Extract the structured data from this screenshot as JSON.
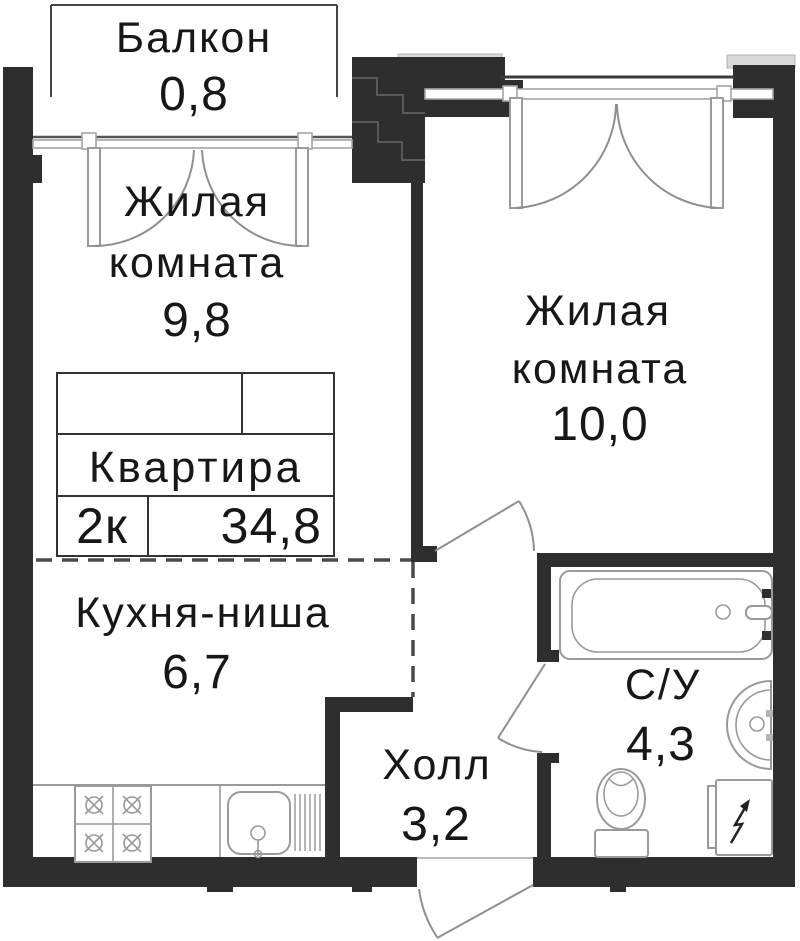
{
  "plan": {
    "balcony": {
      "name": "Балкон",
      "area": "0,8"
    },
    "living_room_1": {
      "name_line1": "Жилая",
      "name_line2": "комната",
      "area": "9,8"
    },
    "living_room_2": {
      "name_line1": "Жилая",
      "name_line2": "комната",
      "area": "10,0"
    },
    "kitchen": {
      "name": "Кухня-ниша",
      "area": "6,7"
    },
    "hall": {
      "name": "Холл",
      "area": "3,2"
    },
    "bathroom": {
      "name": "С/У",
      "area": "4,3"
    },
    "title_block": {
      "label": "Квартира",
      "rooms_count": "2к",
      "total_area": "34,8"
    },
    "colors": {
      "wall": "#2e2e2e",
      "slab": "#d9d9d9",
      "line": "#9a9a9a"
    }
  }
}
